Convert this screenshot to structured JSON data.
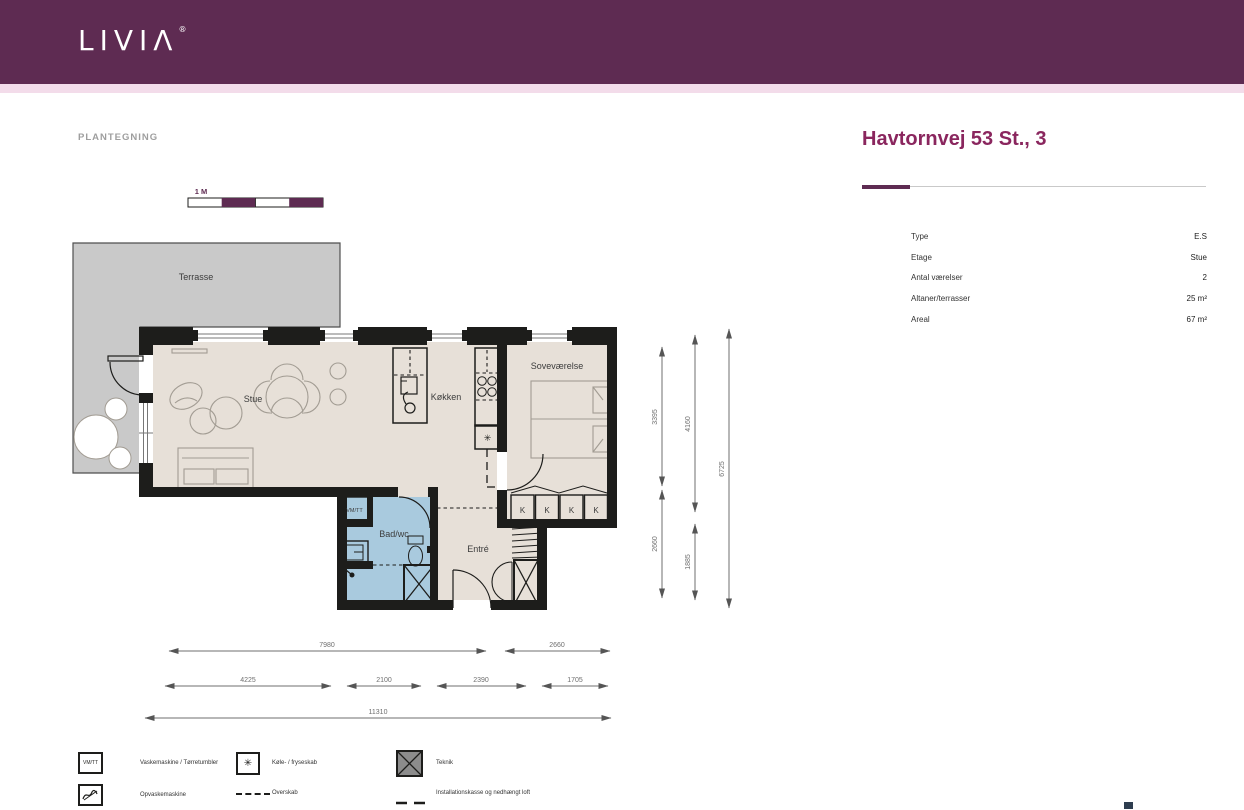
{
  "header": {
    "logo_text": "LIVIΛ",
    "logo_reg": "®"
  },
  "plan": {
    "section_label": "PLANTEGNING",
    "scale_label": "1 M",
    "rooms": {
      "terrasse": "Terrasse",
      "stue": "Stue",
      "koekken": "Køkken",
      "sovevaerelse": "Soveværelse",
      "bad": "Bad/wc",
      "entre": "Entré",
      "vmtt": "VM/TT"
    },
    "wardrobe_label": "K",
    "fridge_symbol": "✳",
    "dims": {
      "v1a": "3395",
      "v1b": "2660",
      "v2a": "4160",
      "v2b": "1885",
      "v3": "6725",
      "h1a": "7980",
      "h1b": "2660",
      "h2a": "4225",
      "h2b": "2100",
      "h2c": "2390",
      "h2d": "1705",
      "h3": "11310"
    }
  },
  "info": {
    "title": "Havtornvej 53 St., 3",
    "rows": [
      {
        "label": "Type",
        "value": "E.S"
      },
      {
        "label": "Etage",
        "value": "Stue"
      },
      {
        "label": "Antal værelser",
        "value": "2"
      },
      {
        "label": "Altaner/terrasser",
        "value": "25 m²"
      },
      {
        "label": "Areal",
        "value": "67 m²"
      }
    ]
  },
  "legend": {
    "vmtt_symbol": "VM/TT",
    "fridge_symbol": "✳",
    "items": [
      {
        "label": "Vaskemaskine / Tørretumbler"
      },
      {
        "label": "Opvaskemaskine"
      },
      {
        "label": "Køle- / fryseskab"
      },
      {
        "label": "Overskab"
      },
      {
        "label": "Teknik"
      },
      {
        "label": "Installationskasse og nedhængt loft"
      }
    ]
  },
  "colors": {
    "brand": "#5e2b52",
    "strip": "#f3dcea",
    "title": "#8a265e",
    "floor": "#e7e0d8",
    "terr": "#c9c9c9",
    "bath": "#a9cade",
    "wall": "#1d1d1b",
    "tek": "#8c8c8c",
    "furn": "#a29c93",
    "dim": "#6f6f6f",
    "txt": "#3c3c3c",
    "lab": "#9e9e9e"
  }
}
